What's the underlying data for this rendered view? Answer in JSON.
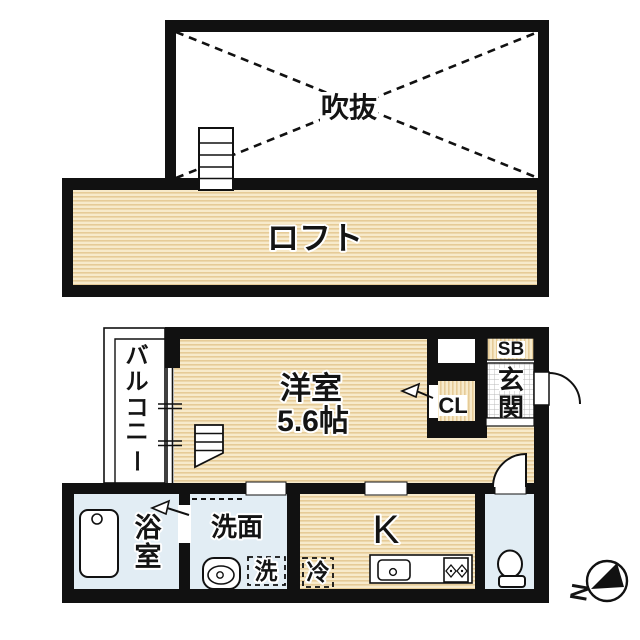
{
  "floor_plan": {
    "upper_level": {
      "void_label": "吹抜",
      "loft_label": "ロフト"
    },
    "main_level": {
      "room_label": "洋室",
      "room_size_label": "5.6帖",
      "balcony_label": "バルコニー",
      "balcony_chars": [
        "バ",
        "ル",
        "コ",
        "ニ",
        "ー"
      ],
      "closet_label": "CL",
      "shoe_box_label": "SB",
      "entrance_label": "玄関",
      "entrance_chars": [
        "玄",
        "関"
      ],
      "bathroom_label": "浴室",
      "bathroom_chars": [
        "浴",
        "室"
      ],
      "washroom_label": "洗面",
      "washer_label": "洗",
      "fridge_label": "冷",
      "kitchen_label": "K"
    },
    "compass": {
      "north_label": "N"
    },
    "colors": {
      "wall": "#111111",
      "wood_floor_base": "#f7eacb",
      "wood_floor_stripe": "#e6cb97",
      "wet_area": "#e2edf4",
      "background": "#ffffff"
    }
  }
}
